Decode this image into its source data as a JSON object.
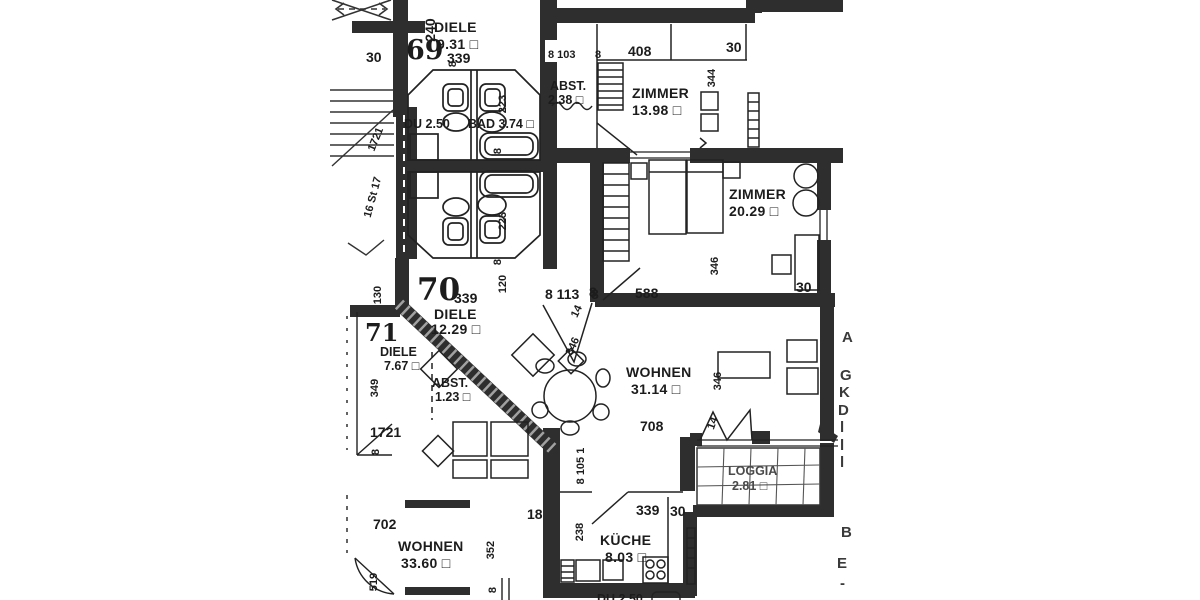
{
  "meta": {
    "kind": "scanned architectural floor plan",
    "language": "German"
  },
  "colors": {
    "paper": "#ffffff",
    "ink": "#222222",
    "wall": "#2e2e2e"
  },
  "units": {
    "u69": "69",
    "u70": "70",
    "u71": "71"
  },
  "rooms": {
    "diele69": {
      "name": "DIELE",
      "area": "9.31 □"
    },
    "du69": {
      "name": "DU 2.50"
    },
    "bad69": {
      "name": "BAD 3.74 □"
    },
    "abst_top": {
      "name": "ABST.",
      "area": "2.38 □"
    },
    "zimmer1": {
      "name": "ZIMMER",
      "area": "13.98 □"
    },
    "zimmer2": {
      "name": "ZIMMER",
      "area": "20.29 □"
    },
    "diele70": {
      "name": "DIELE",
      "area": "12.29 □"
    },
    "diele71": {
      "name": "DIELE",
      "area": "7.67 □"
    },
    "abst71": {
      "name": "ABST.",
      "area": "1.23 □"
    },
    "wohnen70": {
      "name": "WOHNEN",
      "area": "31.14 □"
    },
    "loggia": {
      "name": "LOGGIA",
      "area": "2.81 □"
    },
    "kueche": {
      "name": "KÜCHE",
      "area": "8.03 □"
    },
    "wohnen_lower": {
      "name": "WOHNEN",
      "area": "33.60 □"
    }
  },
  "dims": {
    "tl_30": "30",
    "tl_339": "339",
    "v_240": "240",
    "v_8a": "8",
    "tr_8_103": "8 103",
    "tr_8": "8",
    "tr_408": "408",
    "tr_30": "30",
    "v_344": "344",
    "bath1_223": "223",
    "bath1_8": "8",
    "bath2_223": "223",
    "bath2_8": "8",
    "z2_346": "346",
    "z2_30": "30",
    "z2_8": "8",
    "z2_588": "588",
    "d70_339": "339",
    "v_120": "120",
    "entry_8_113": "8 113",
    "entry_8": "8",
    "entry_14": "14",
    "entry_346": "346",
    "u71_349": "349",
    "u71_1721": "1721",
    "u71_8": "8",
    "wohnen_708": "708",
    "wohnen_346": "346",
    "zig_14": "14",
    "k_8_105_1": "8 105 1",
    "k_18": "18",
    "k_238": "238",
    "k_339": "339",
    "k_30": "30",
    "low_702": "702",
    "low_352": "352",
    "low_519": "519",
    "low_8": "8",
    "stair_130": "130",
    "stair_16st17": "16 St 17",
    "stair_1721": "1721"
  },
  "fragments": {
    "right": [
      "A",
      "G",
      "K",
      "D",
      "l",
      "l",
      "l",
      "B",
      "E",
      "-"
    ],
    "bottom": "DU 2.50"
  }
}
